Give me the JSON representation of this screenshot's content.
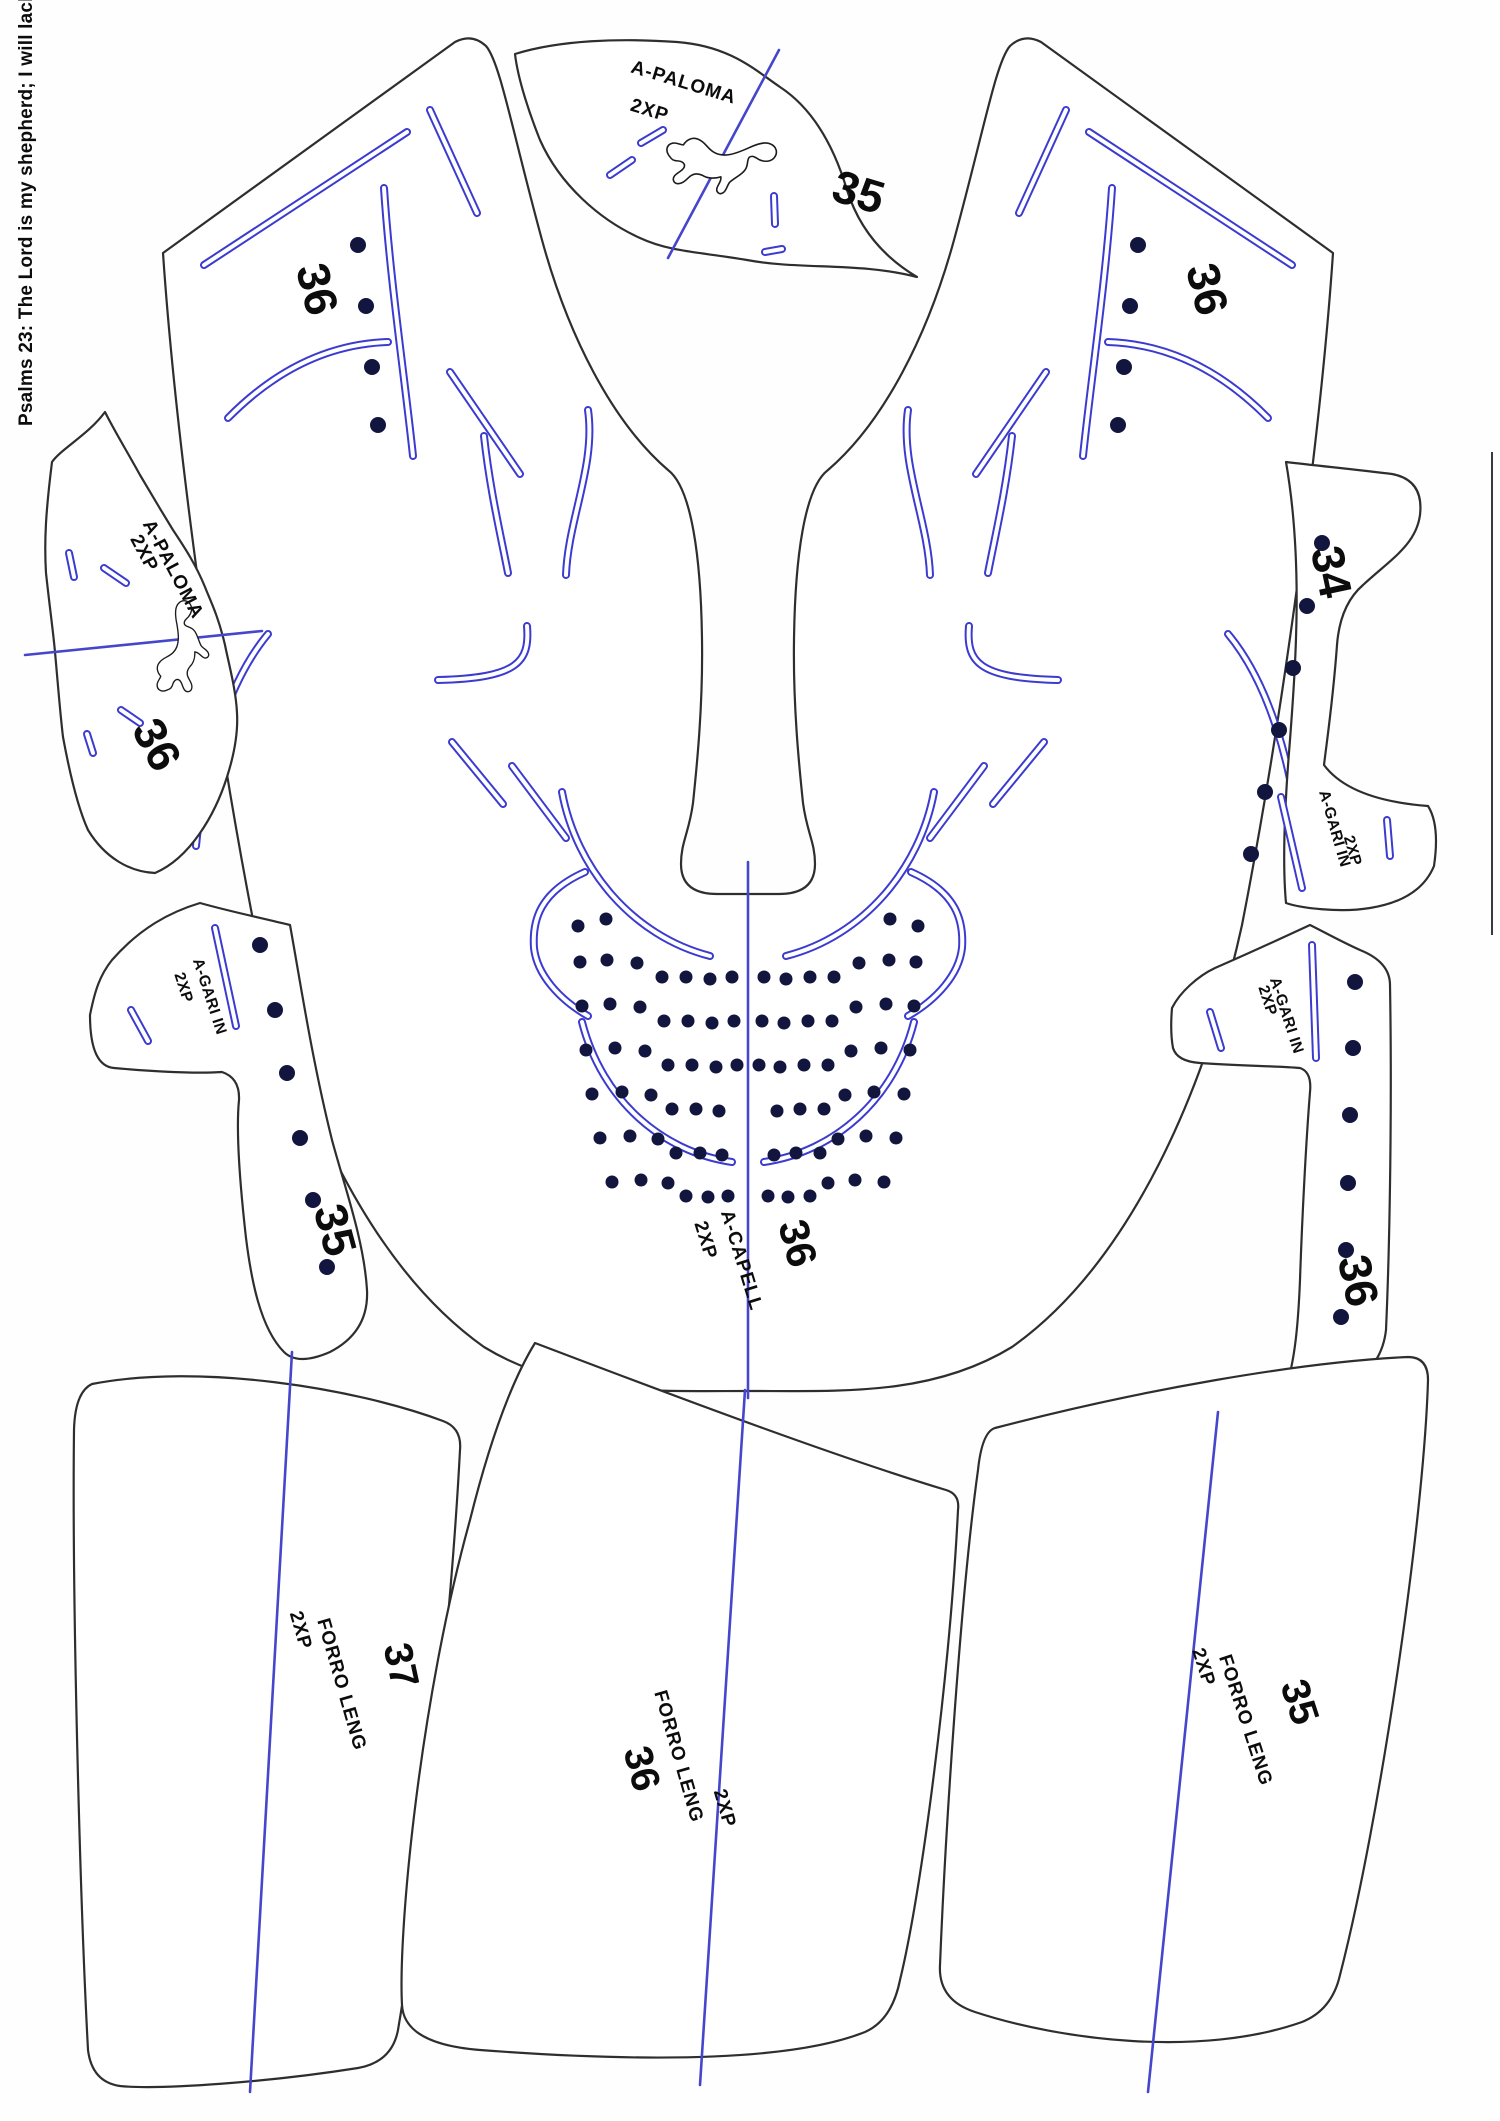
{
  "document": {
    "verse": "Psalms 23: The Lord is my shepherd; I will lack nothing."
  },
  "pieces": {
    "paloma_top": {
      "name": "A-PALOMA",
      "qty": "2XP",
      "size": "35"
    },
    "paloma_left": {
      "name": "A-PALOMA",
      "qty": "2XP",
      "size": "36"
    },
    "capell": {
      "name": "A-CAPELL",
      "qty": "2XP",
      "size": "36",
      "size_mark_left": "36",
      "size_mark_right": "36"
    },
    "gari_34": {
      "name": "A-GARI IN",
      "qty": "2XP",
      "size": "34"
    },
    "gari_35": {
      "name": "A-GARI IN",
      "qty": "2XP",
      "size": "35"
    },
    "gari_36": {
      "name": "A-GARI IN",
      "qty": "2XP",
      "size": "36"
    },
    "forro_37": {
      "name": "FORRO LENG",
      "qty": "2XP",
      "size": "37"
    },
    "forro_36": {
      "name": "FORRO LENG",
      "qty": "2XP",
      "size": "36"
    },
    "forro_35": {
      "name": "FORRO LENG",
      "qty": "2XP",
      "size": "35"
    }
  },
  "colors": {
    "cut_outline": "#2e2e2e",
    "stitch_blue": "#3b3bd0",
    "grain_blue": "#4646cc",
    "dot_navy": "#12163f",
    "label_text": "#0c0c0c"
  },
  "icons": {
    "logo": "puma-cat-logo"
  }
}
